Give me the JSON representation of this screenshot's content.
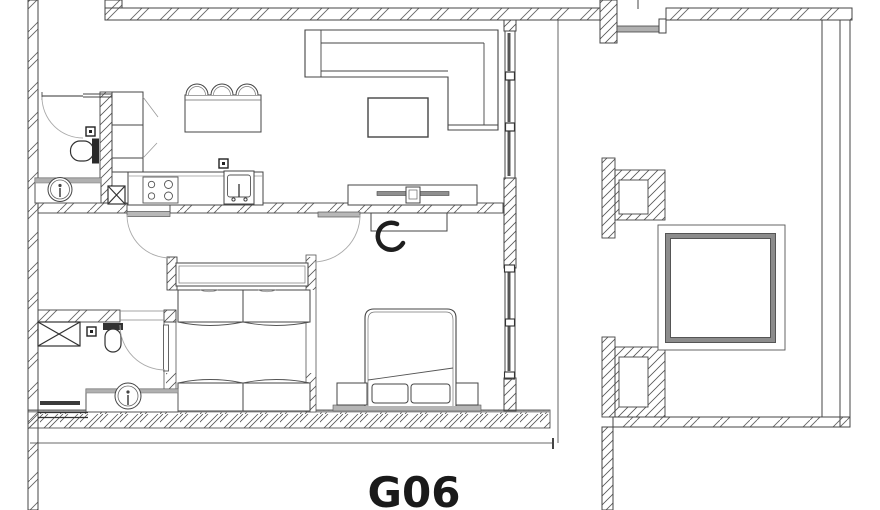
{
  "drawing": {
    "unit_label": "G06"
  },
  "colors": {
    "background": "#ffffff",
    "line": "#3c3c3c",
    "hatch": "#5a5a5a",
    "door_leaf_gray": "#b8b8b8",
    "glazing_dark": "#555555",
    "elevator_border_gray": "#8c8c8c",
    "platform_gray": "#b5b5b5",
    "label_color": "#1a1a1a"
  },
  "rooms": [
    {
      "name": "bathroom-1",
      "fixtures": [
        "entry-door-swing-icon",
        "toilet-icon",
        "vanity-sink-icon",
        "wall-outlet-icon"
      ]
    },
    {
      "name": "kitchen",
      "fixtures": [
        "tall-cabinet-icon",
        "appliance-x-box-icon",
        "cooktop-4-burner-icon",
        "kitchen-sink-icon",
        "island-counter-icon",
        "bar-stool-icon",
        "bar-stool-icon",
        "bar-stool-icon",
        "wall-outlet-icon"
      ]
    },
    {
      "name": "living-room",
      "fixtures": [
        "l-sofa-icon",
        "coffee-table-icon",
        "tv-console-icon",
        "tv-icon"
      ]
    },
    {
      "name": "bedroom-1",
      "fixtures": [
        "headboard-shelf-icon",
        "single-bed-icon",
        "single-bed-icon",
        "door-swing-icon"
      ]
    },
    {
      "name": "bedroom-2",
      "fixtures": [
        "double-bed-icon",
        "pillow-icon",
        "pillow-icon",
        "nightstand-icon",
        "nightstand-icon",
        "desk-icon",
        "chair-icon",
        "door-swing-icon",
        "window-icon"
      ]
    },
    {
      "name": "bathroom-2",
      "fixtures": [
        "shower-tray-x-icon",
        "toilet-icon",
        "round-sink-vanity-icon",
        "towel-rail-icon",
        "door-swing-icon",
        "wall-outlet-icon"
      ]
    },
    {
      "name": "core-corridor",
      "fixtures": [
        "elevator-shaft-icon",
        "structural-column-icon",
        "structural-column-icon",
        "stair-opening-icon"
      ]
    }
  ]
}
